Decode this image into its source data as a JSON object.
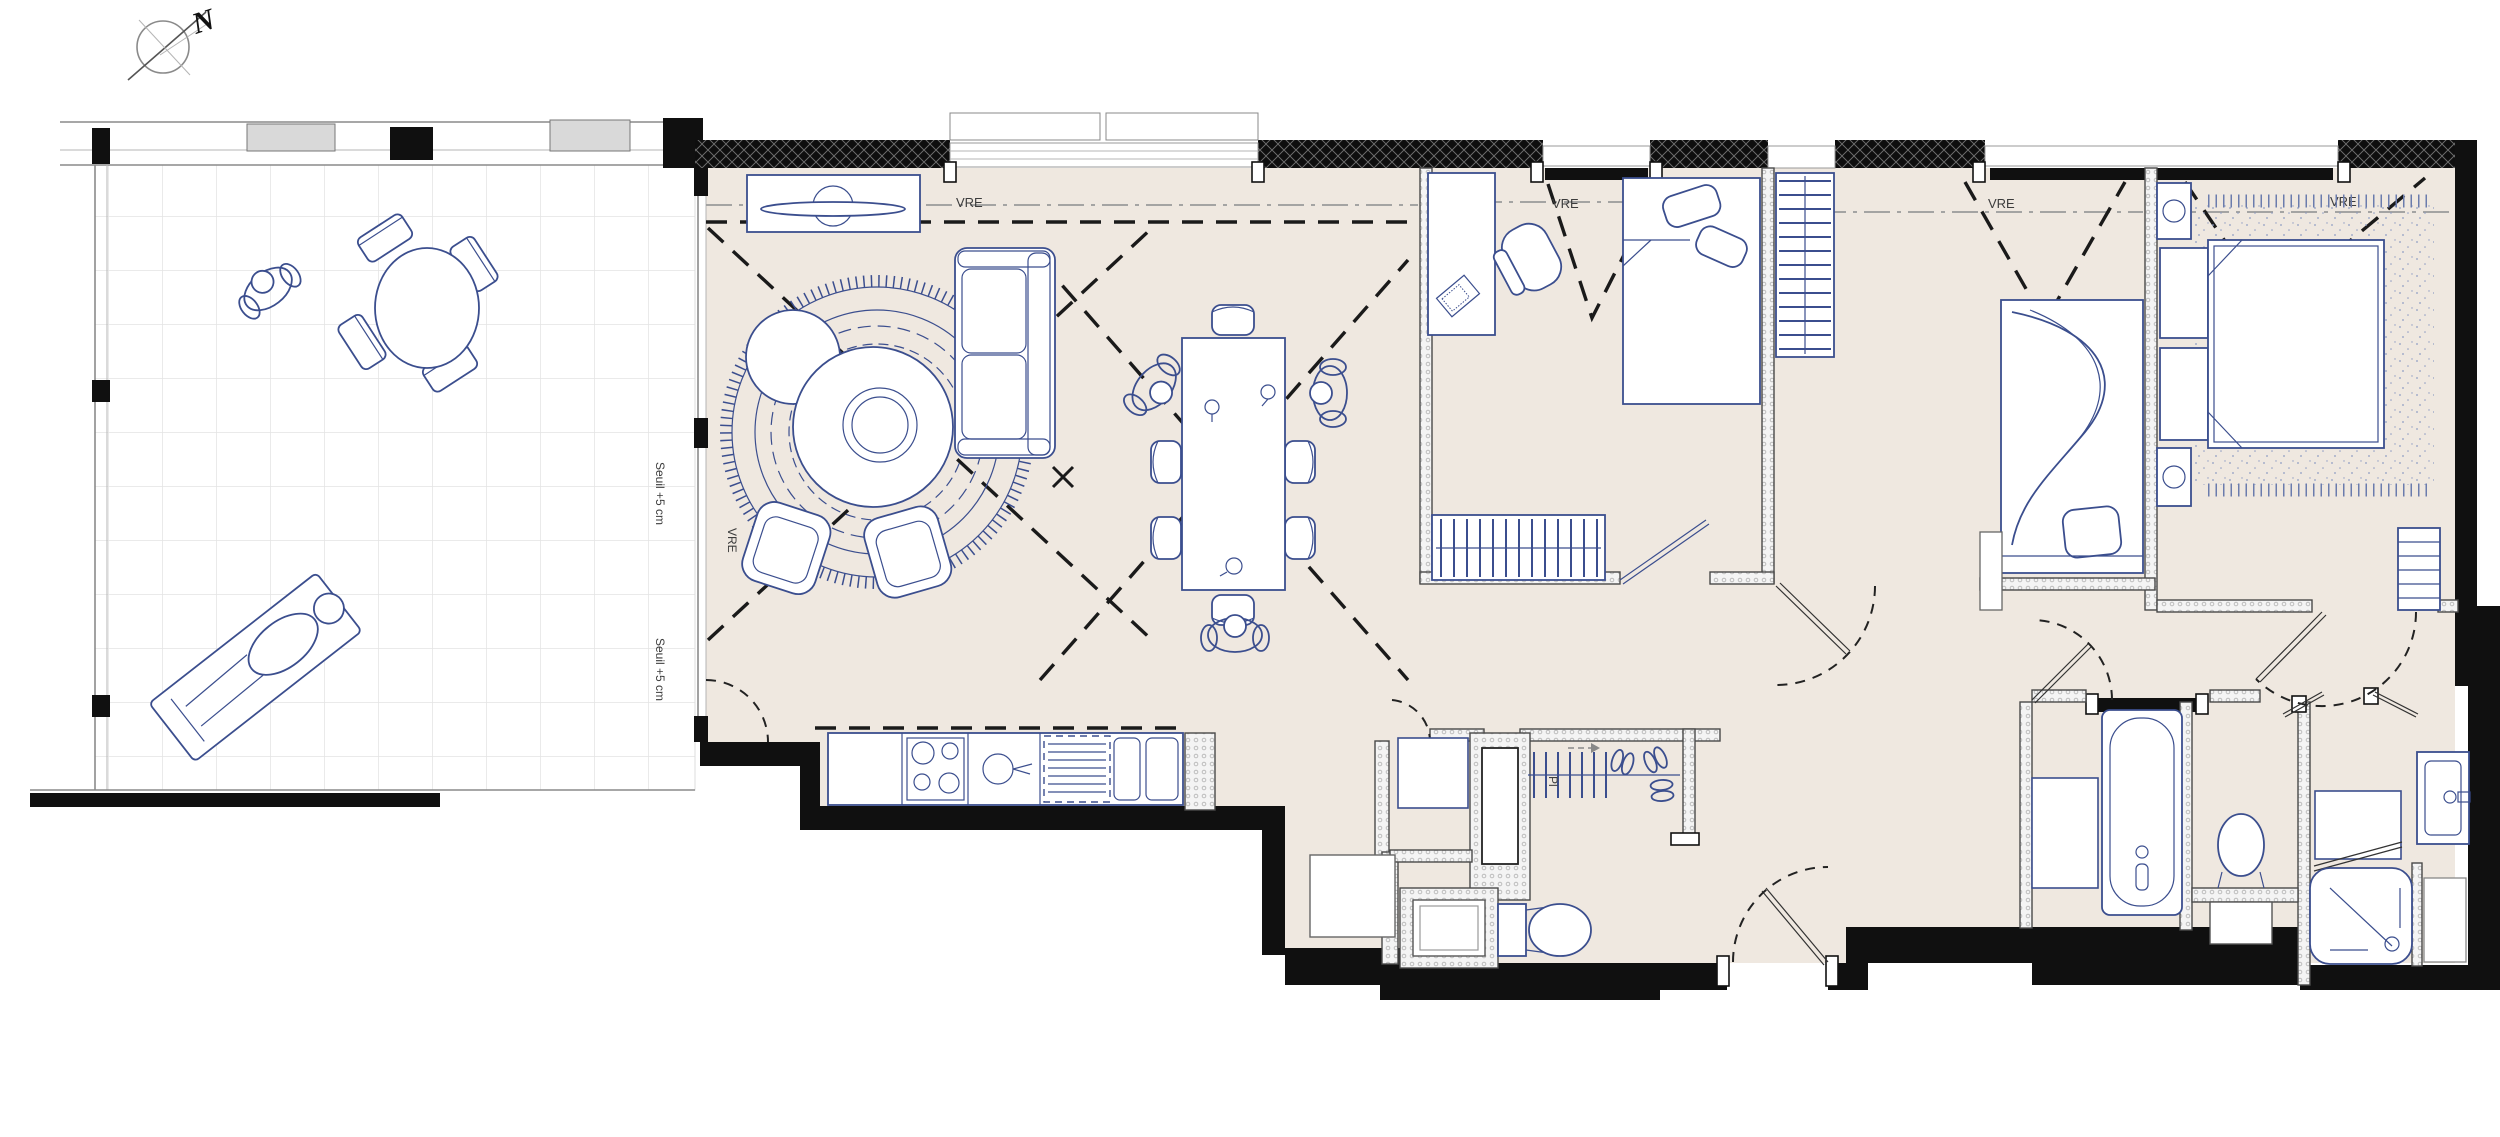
{
  "drawing": {
    "type": "apartment floor plan",
    "background": "#ffffff"
  },
  "compass": {
    "north_label": "N"
  },
  "annotations": {
    "vre_label": "VRE",
    "threshold_label": "Seuil +5 cm",
    "closet_label": "Pl"
  },
  "colors": {
    "floor_beige": "#efe8e0",
    "terrace_white": "#ffffff",
    "tile_grid_gray": "#e3e3e3",
    "furniture_blue": "#3b4e8e",
    "exterior_wall_black": "#101010",
    "partition_wall_gray": "#c9c9c9",
    "dashed_line_black": "#1a1a1a",
    "projection_line_gray": "#9a9a9a",
    "label_text_gray": "#3c3c3c",
    "carpet_stipple_blue": "#8e9cc2"
  }
}
